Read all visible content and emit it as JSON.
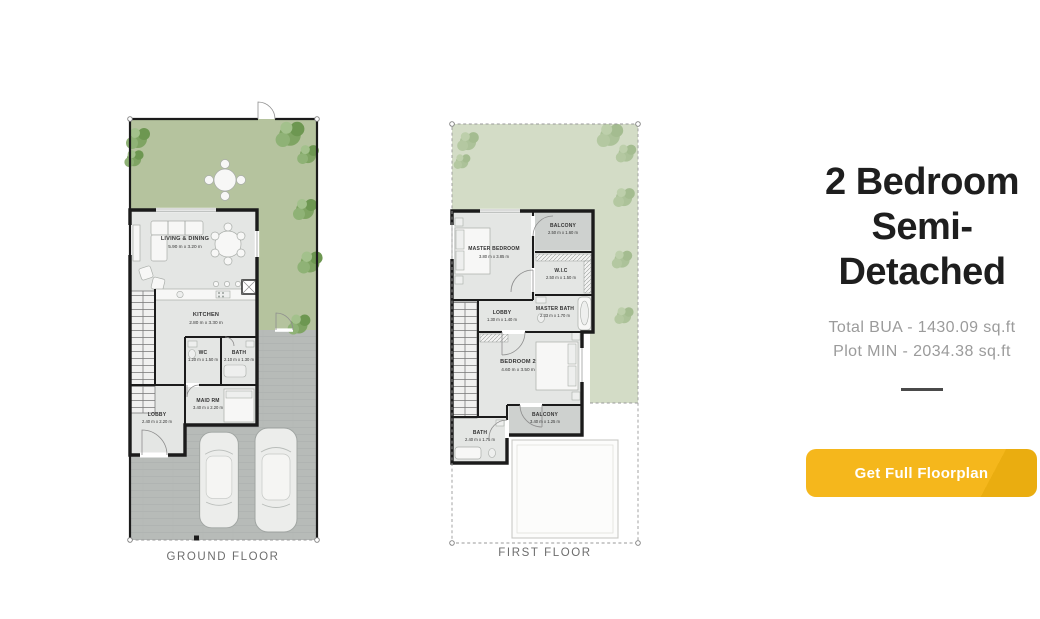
{
  "panel": {
    "title": "2 Bedroom Semi-Detached",
    "title_lines": [
      "2 Bedroom",
      "Semi-",
      "Detached"
    ],
    "specs": [
      "Total BUA - 1430.09 sq.ft",
      "Plot MIN - 2034.38 sq.ft"
    ],
    "cta_label": "Get Full Floorplan"
  },
  "ground_floor": {
    "label": "GROUND FLOOR",
    "rooms": [
      {
        "name": "LIVING & DINING",
        "dims": "5.90 m x 3.20 m"
      },
      {
        "name": "KITCHEN",
        "dims": "2.80 m x 3.30 m"
      },
      {
        "name": "WC",
        "dims": "1.20 m x 1.50 m"
      },
      {
        "name": "BATH",
        "dims": "2.10 m x 1.30 m"
      },
      {
        "name": "MAID RM",
        "dims": "3.40 m x 2.20 m"
      },
      {
        "name": "LOBBY",
        "dims": "2.40 m x 2.20 m"
      }
    ]
  },
  "first_floor": {
    "label": "FIRST FLOOR",
    "rooms": [
      {
        "name": "MASTER BEDROOM",
        "dims": "3.80 m x 3.85 m"
      },
      {
        "name": "BALCONY",
        "dims": "2.50 m x 1.60 m"
      },
      {
        "name": "W.I.C",
        "dims": "2.50 m x 1.50 m"
      },
      {
        "name": "MASTER BATH",
        "dims": "2.33 m x 1.70 m"
      },
      {
        "name": "LOBBY",
        "dims": "1.30 m x 1.40 m"
      },
      {
        "name": "BEDROOM 2",
        "dims": "4.60 m x 3.50 m"
      },
      {
        "name": "BALCONY",
        "dims": "3.40 m x 1.25 m"
      },
      {
        "name": "BATH",
        "dims": "2.40 m x 1.75 m"
      }
    ]
  },
  "colors": {
    "accent_yellow": "#f5b71c",
    "accent_yellow_dark": "#eaad10",
    "title_text": "#1e1e1e",
    "spec_text": "#9b9b9b",
    "divider": "#4a4a4a",
    "caption_text": "#6d6d6d",
    "garden_green": "#b5c39e",
    "garden_green_light": "#d3dcc6",
    "driveway_gray": "#b7bbb8",
    "floor_gray": "#e4e6e4",
    "balcony_gray": "#ced1cf",
    "wall_black": "#1b1b1b",
    "label_text": "#333333",
    "plot_line": "#9a9a9a"
  }
}
